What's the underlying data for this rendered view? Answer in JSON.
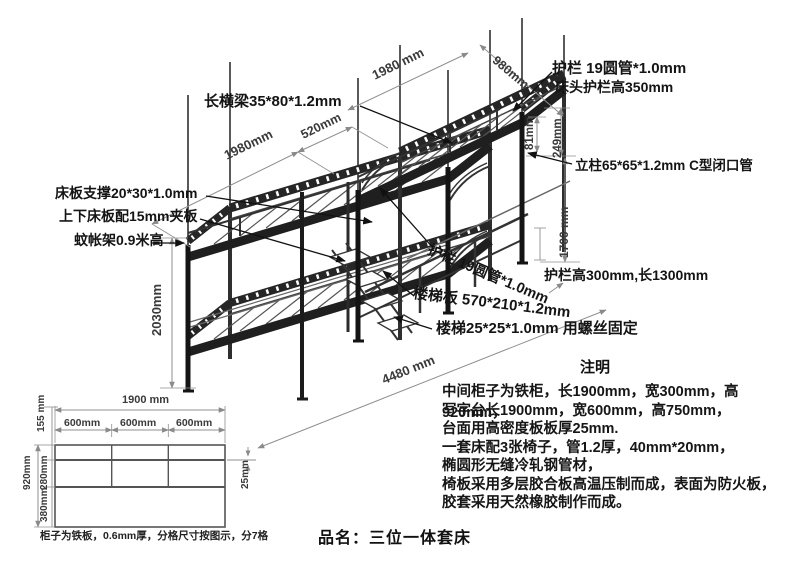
{
  "diagram": {
    "labels": {
      "long_beam": "长横梁35*80*1.2mm",
      "head_guard_line1": "护栏 19圆管*1.0mm",
      "head_guard_line2": "床头护栏高350mm",
      "post": "立柱65*65*1.2mm C型闭口管",
      "board_support": "床板支撑20*30*1.0mm",
      "board": "上下床板配15mm夹板",
      "mosquito_net": "蚊帐架0.9米高",
      "side_guard_tube": "护栏 19圆管*1.0mm",
      "side_guard_size": "护栏高300mm,长1300mm",
      "ladder_board": "楼梯板 570*210*1.2mm",
      "ladder_tube": "楼梯25*25*1.0mm 用螺丝固定"
    },
    "dims": {
      "left_bed_length": "1980mm",
      "bed_gap": "520mm",
      "right_bed_length": "1980 mm",
      "bed_width": "980mm",
      "rail_offset": "81mm",
      "head_height": "249mm",
      "clearance_height": "1700 mm",
      "total_height": "2030mm",
      "total_length": "4480 mm"
    }
  },
  "cabinet": {
    "width_total": "1900 mm",
    "cells": [
      "600mm",
      "600mm",
      "600mm"
    ],
    "row_heights": {
      "top": "155 mm",
      "middle": "280mm",
      "bottom": "380mm"
    },
    "height_total": "920mm",
    "divider": "25mm",
    "caption": "柜子为铁板，0.6mm厚，分格尺寸按图示，分7格"
  },
  "notes": {
    "title": "注明",
    "lines": [
      "中间柜子为铁柜，长1900mm，宽300mm，高920mm，",
      "写字台长1900mm，宽600mm，高750mm，",
      "台面用高密度板板厚25mm.",
      "一套床配3张椅子，管1.2厚，40mm*20mm，",
      "椭圆形无缝冷轧钢管材，",
      "椅板采用多层胶合板高温压制而成，表面为防火板，",
      "胶套采用天然橡胶制作而成。"
    ]
  },
  "product": {
    "name": "品名：三位一体套床"
  }
}
